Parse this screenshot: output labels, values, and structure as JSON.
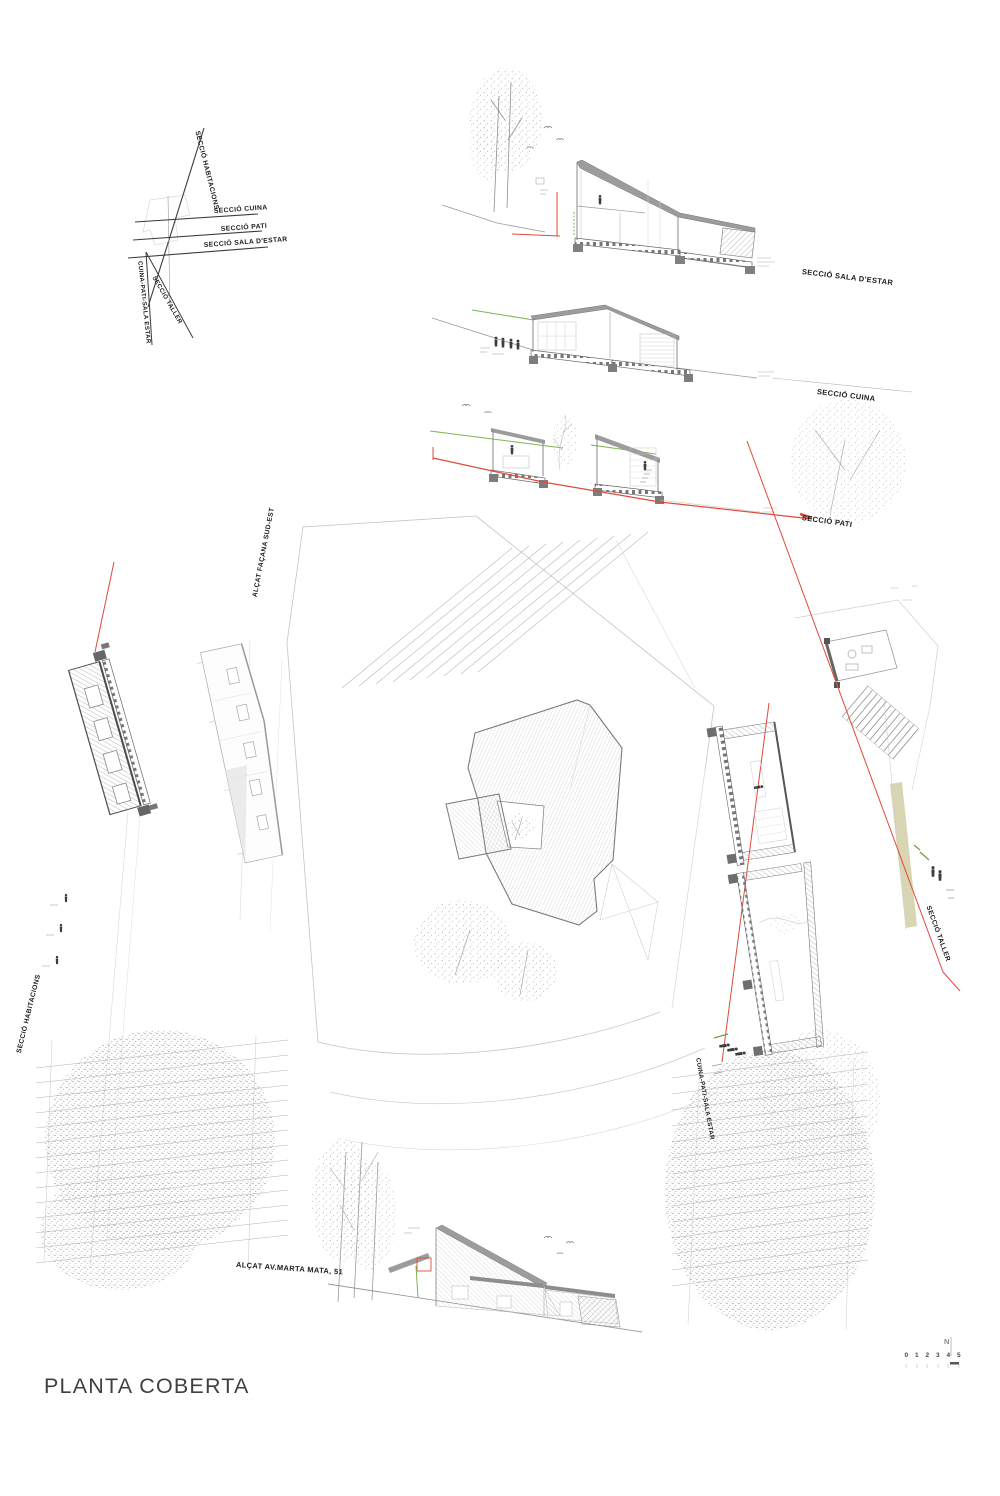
{
  "sheet": {
    "title": "PLANTA COBERTA",
    "north_label": "N",
    "scale_values": [
      "0",
      "1",
      "2",
      "3",
      "4",
      "5"
    ]
  },
  "labels": {
    "seccio_habitacions": "SECCIÓ HABITACIONS",
    "seccio_cuina": "SECCIÓ CUINA",
    "seccio_pati": "SECCIÓ PATI",
    "seccio_sala_destar": "SECCIÓ SALA D'ESTAR",
    "cuina_pati_sala_estar": "CUINA-PATI-SALA ESTAR",
    "seccio_taller": "SECCIÓ TALLER",
    "alcat_facana_sud_est": "ALÇAT FAÇANA SUD-EST",
    "alcat_av_marta_mata": "ALÇAT AV.MARTA MATA, 51"
  },
  "colors": {
    "section_cut_line": "#e04a3a",
    "grade_line": "#7cb64e",
    "accent_strip": "#d8d5b2",
    "ink": "#1c1c1c",
    "linework": "#8a8a8a"
  }
}
